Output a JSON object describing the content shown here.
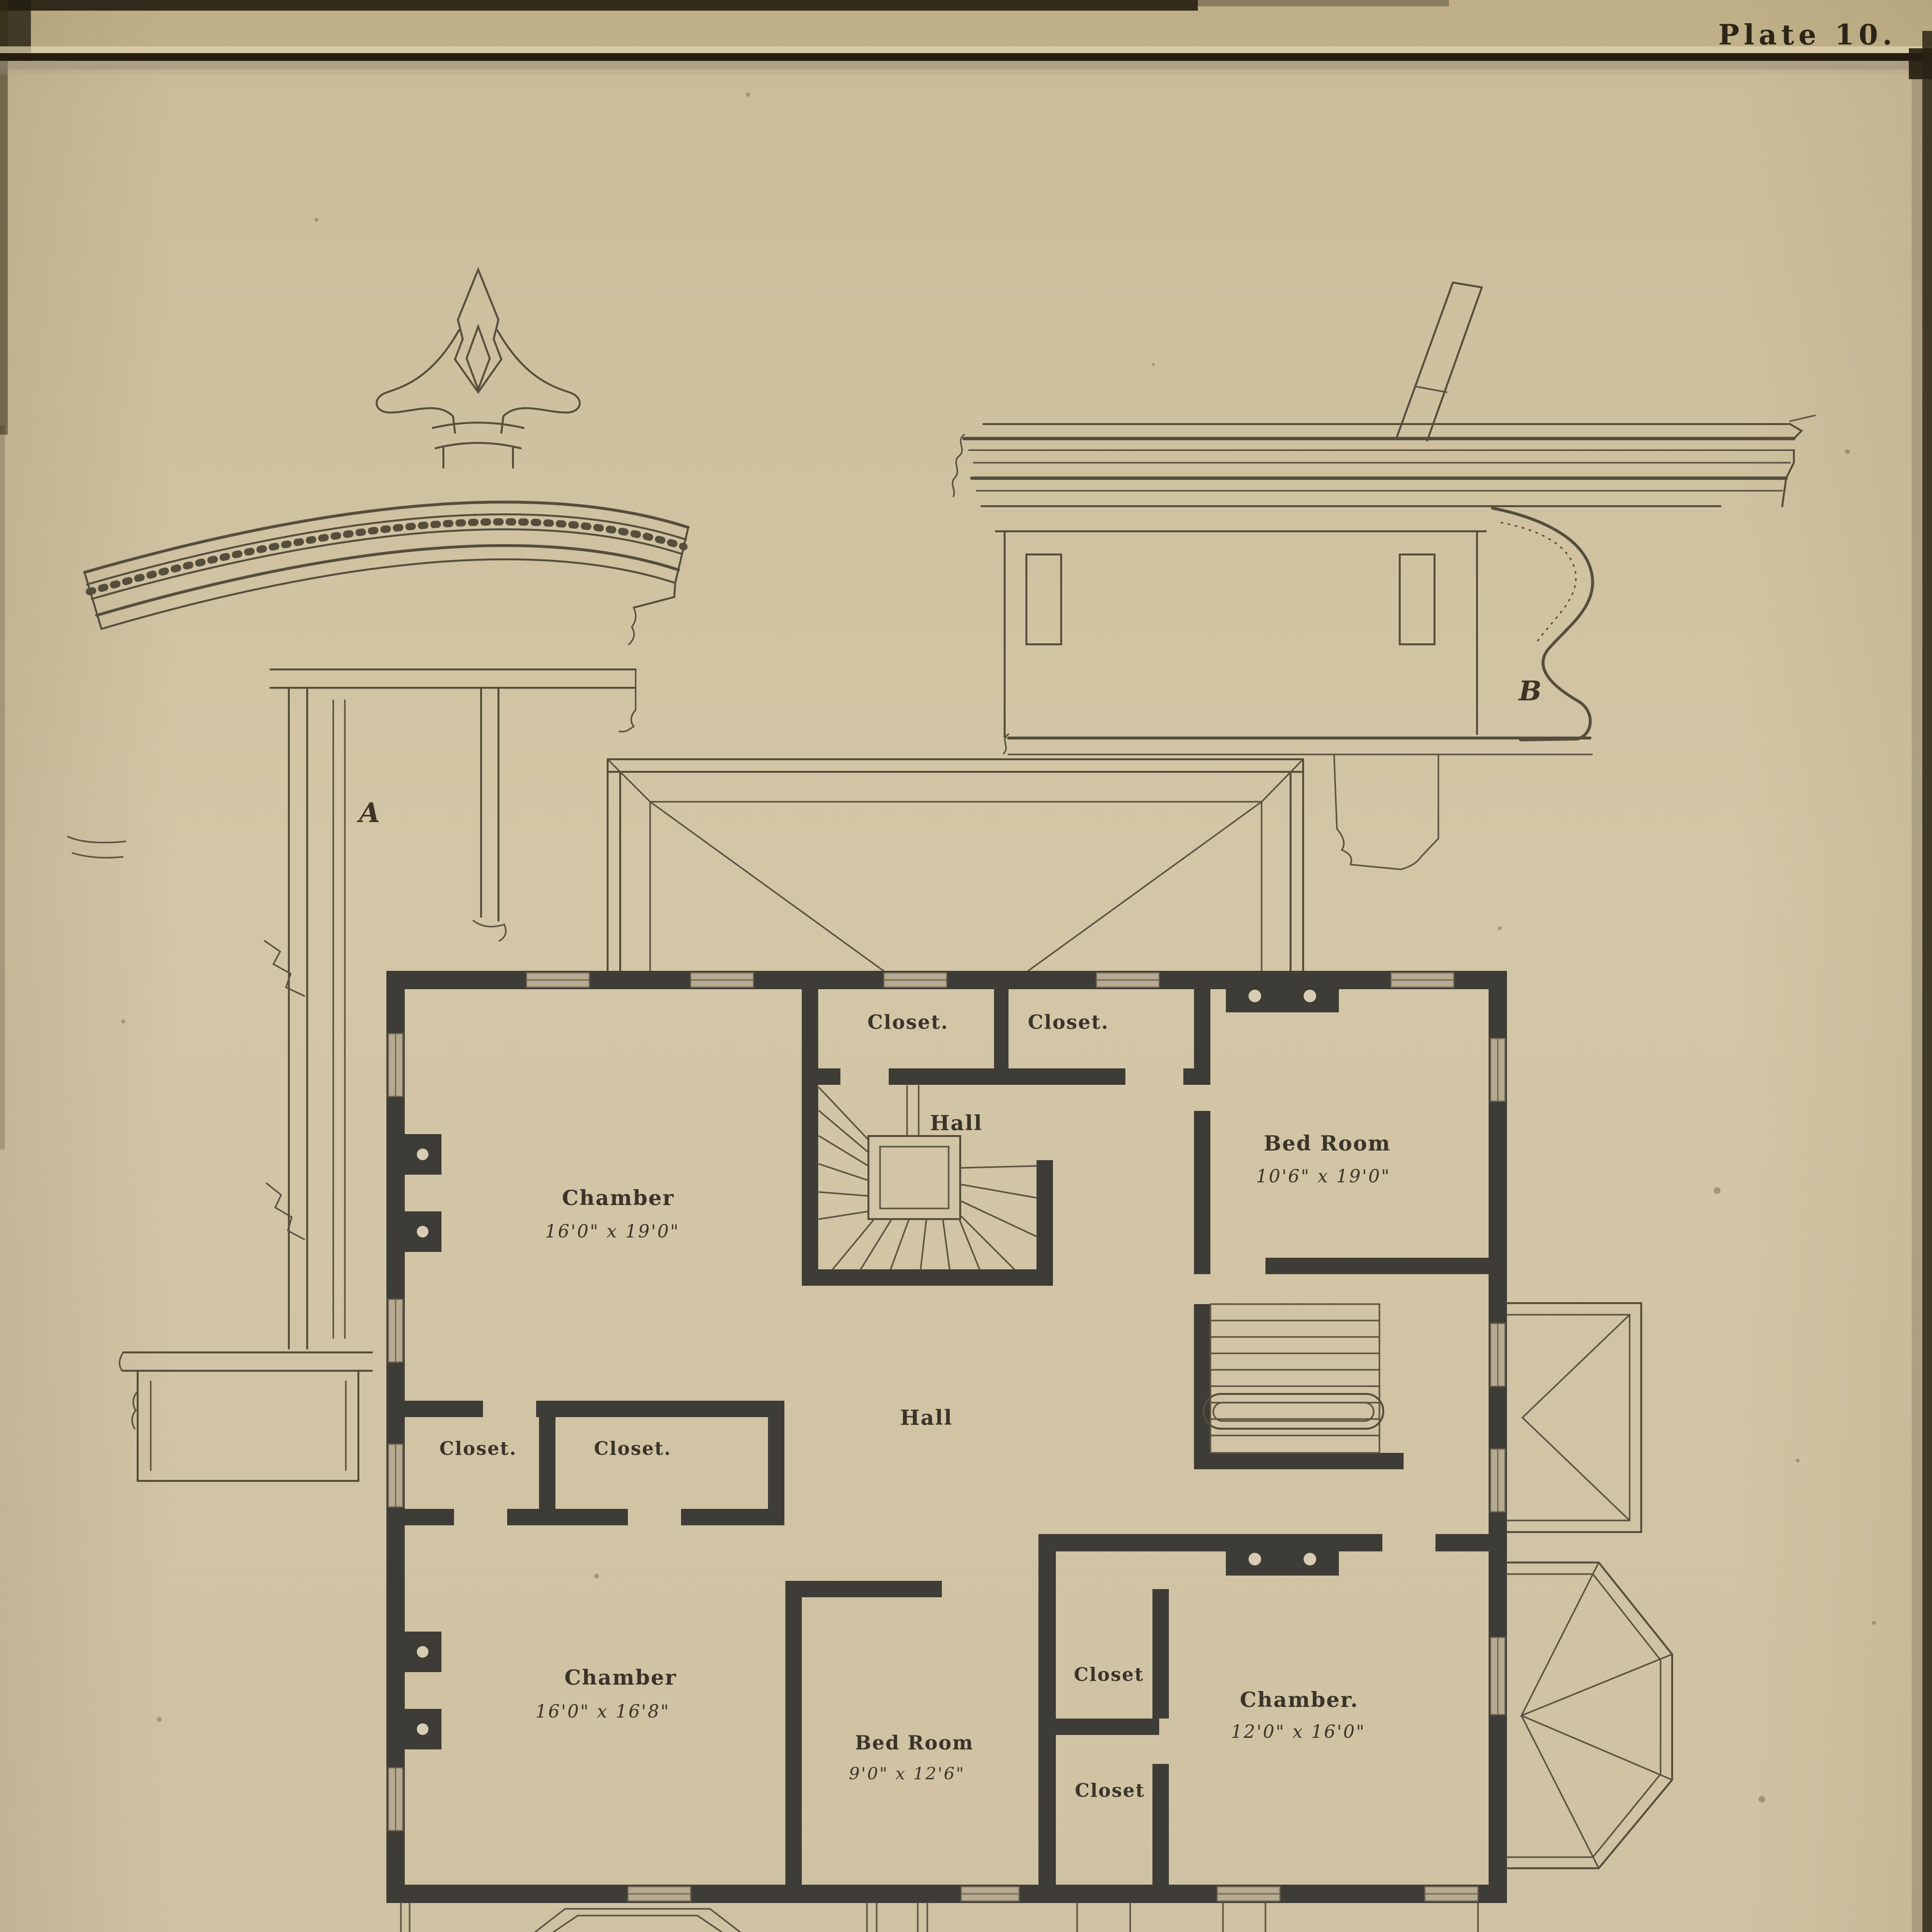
{
  "plate": {
    "title": "Plate 10."
  },
  "details": {
    "a": {
      "label": "A",
      "kind": "window-hood-ornament-detail"
    },
    "b": {
      "label": "B",
      "kind": "cornice-bracket-detail"
    }
  },
  "plan": {
    "rooms": {
      "chamber_nw": {
        "name": "Chamber",
        "dims": "16'0\" x 19'0\""
      },
      "bed_room_ne": {
        "name": "Bed Room",
        "dims": "10'6\" x 19'0\""
      },
      "hall_upper": {
        "name": "Hall"
      },
      "hall_center": {
        "name": "Hall"
      },
      "closet_top_left": {
        "name": "Closet."
      },
      "closet_top_right": {
        "name": "Closet."
      },
      "closet_mid_left": {
        "name": "Closet."
      },
      "closet_mid_right": {
        "name": "Closet."
      },
      "chamber_sw": {
        "name": "Chamber",
        "dims": "16'0\" x 16'8\""
      },
      "bed_room_s": {
        "name": "Bed Room",
        "dims": "9'0\" x 12'6\""
      },
      "closet_se_upper": {
        "name": "Closet"
      },
      "closet_se_lower": {
        "name": "Closet"
      },
      "chamber_se": {
        "name": "Chamber.",
        "dims": "12'0\" x 16'0\""
      }
    }
  },
  "colors": {
    "paper": "#cfc2a2",
    "ink": "#3a342a",
    "wall": "#3e3c36",
    "thin_line": "#554e3c",
    "window_fill": "#b6ab90",
    "rule_dark": "#241d10"
  }
}
